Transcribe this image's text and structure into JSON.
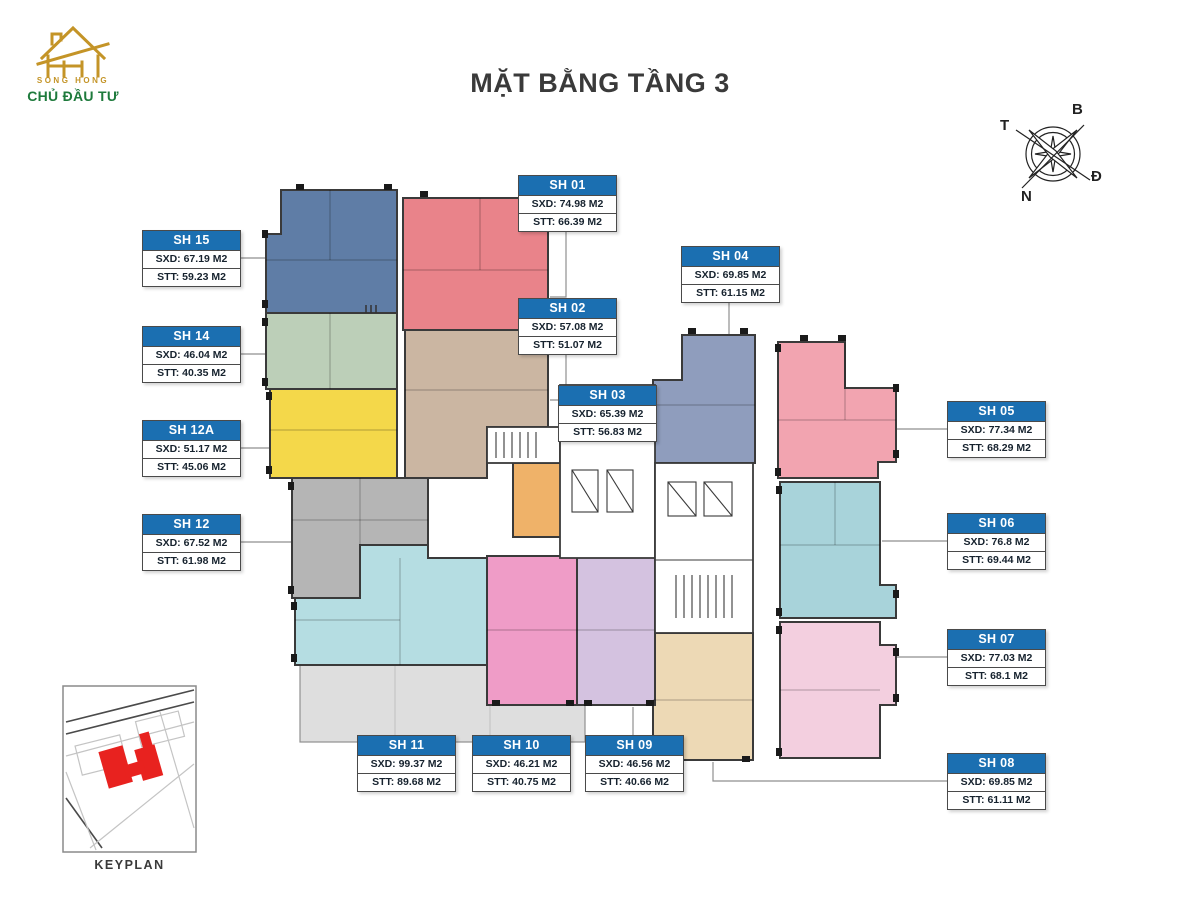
{
  "page": {
    "title": "MẶT BẰNG TẦNG 3"
  },
  "logo": {
    "brand": "SONG HONG",
    "subtitle": "CHỦ ĐẦU TƯ",
    "gold": "#c49427",
    "green": "#1e7a3c"
  },
  "compass": {
    "north": "B",
    "west": "T",
    "east": "Đ",
    "south": "N"
  },
  "keyplan": {
    "label": "KEYPLAN",
    "highlight_color": "#e8221f"
  },
  "colors": {
    "label_header": "#1b6fb1",
    "wall": "#3a3a3a",
    "leader_line": "#8f8f8f",
    "terrace": "#dedede"
  },
  "units": {
    "sh01": {
      "name": "SH 01",
      "sxd": "SXD: 74.98 M2",
      "stt": "STT: 66.39 M2",
      "color": "#e9838a"
    },
    "sh02": {
      "name": "SH 02",
      "sxd": "SXD: 57.08 M2",
      "stt": "STT: 51.07 M2",
      "color": "#cbb6a2"
    },
    "sh03": {
      "name": "SH 03",
      "sxd": "SXD: 65.39 M2",
      "stt": "STT: 56.83 M2",
      "color": "#efb269"
    },
    "sh04": {
      "name": "SH 04",
      "sxd": "SXD: 69.85 M2",
      "stt": "STT: 61.15 M2",
      "color": "#8f9dbd"
    },
    "sh05": {
      "name": "SH 05",
      "sxd": "SXD: 77.34 M2",
      "stt": "STT: 68.29 M2",
      "color": "#f2a4b0"
    },
    "sh06": {
      "name": "SH 06",
      "sxd": "SXD: 76.8 M2",
      "stt": "STT: 69.44 M2",
      "color": "#a8d3da"
    },
    "sh07": {
      "name": "SH 07",
      "sxd": "SXD: 77.03 M2",
      "stt": "STT: 68.1 M2",
      "color": "#f3cfdf"
    },
    "sh08": {
      "name": "SH 08",
      "sxd": "SXD: 69.85 M2",
      "stt": "STT: 61.11 M2",
      "color": "#edd9b5"
    },
    "sh09": {
      "name": "SH 09",
      "sxd": "SXD: 46.56 M2",
      "stt": "STT: 40.66 M2",
      "color": "#d4c2e0"
    },
    "sh10": {
      "name": "SH 10",
      "sxd": "SXD: 46.21 M2",
      "stt": "STT: 40.75 M2",
      "color": "#ef9cc7"
    },
    "sh11": {
      "name": "SH 11",
      "sxd": "SXD: 99.37 M2",
      "stt": "STT: 89.68 M2",
      "color": "#b5dde2"
    },
    "sh12": {
      "name": "SH 12",
      "sxd": "SXD: 67.52 M2",
      "stt": "STT: 61.98 M2",
      "color": "#b5b5b5"
    },
    "sh12a": {
      "name": "SH 12A",
      "sxd": "SXD: 51.17 M2",
      "stt": "STT: 45.06 M2",
      "color": "#f4d84a"
    },
    "sh14": {
      "name": "SH 14",
      "sxd": "SXD: 46.04 M2",
      "stt": "STT: 40.35 M2",
      "color": "#bccfb8"
    },
    "sh15": {
      "name": "SH 15",
      "sxd": "SXD: 67.19 M2",
      "stt": "STT: 59.23 M2",
      "color": "#5f7da6"
    }
  }
}
